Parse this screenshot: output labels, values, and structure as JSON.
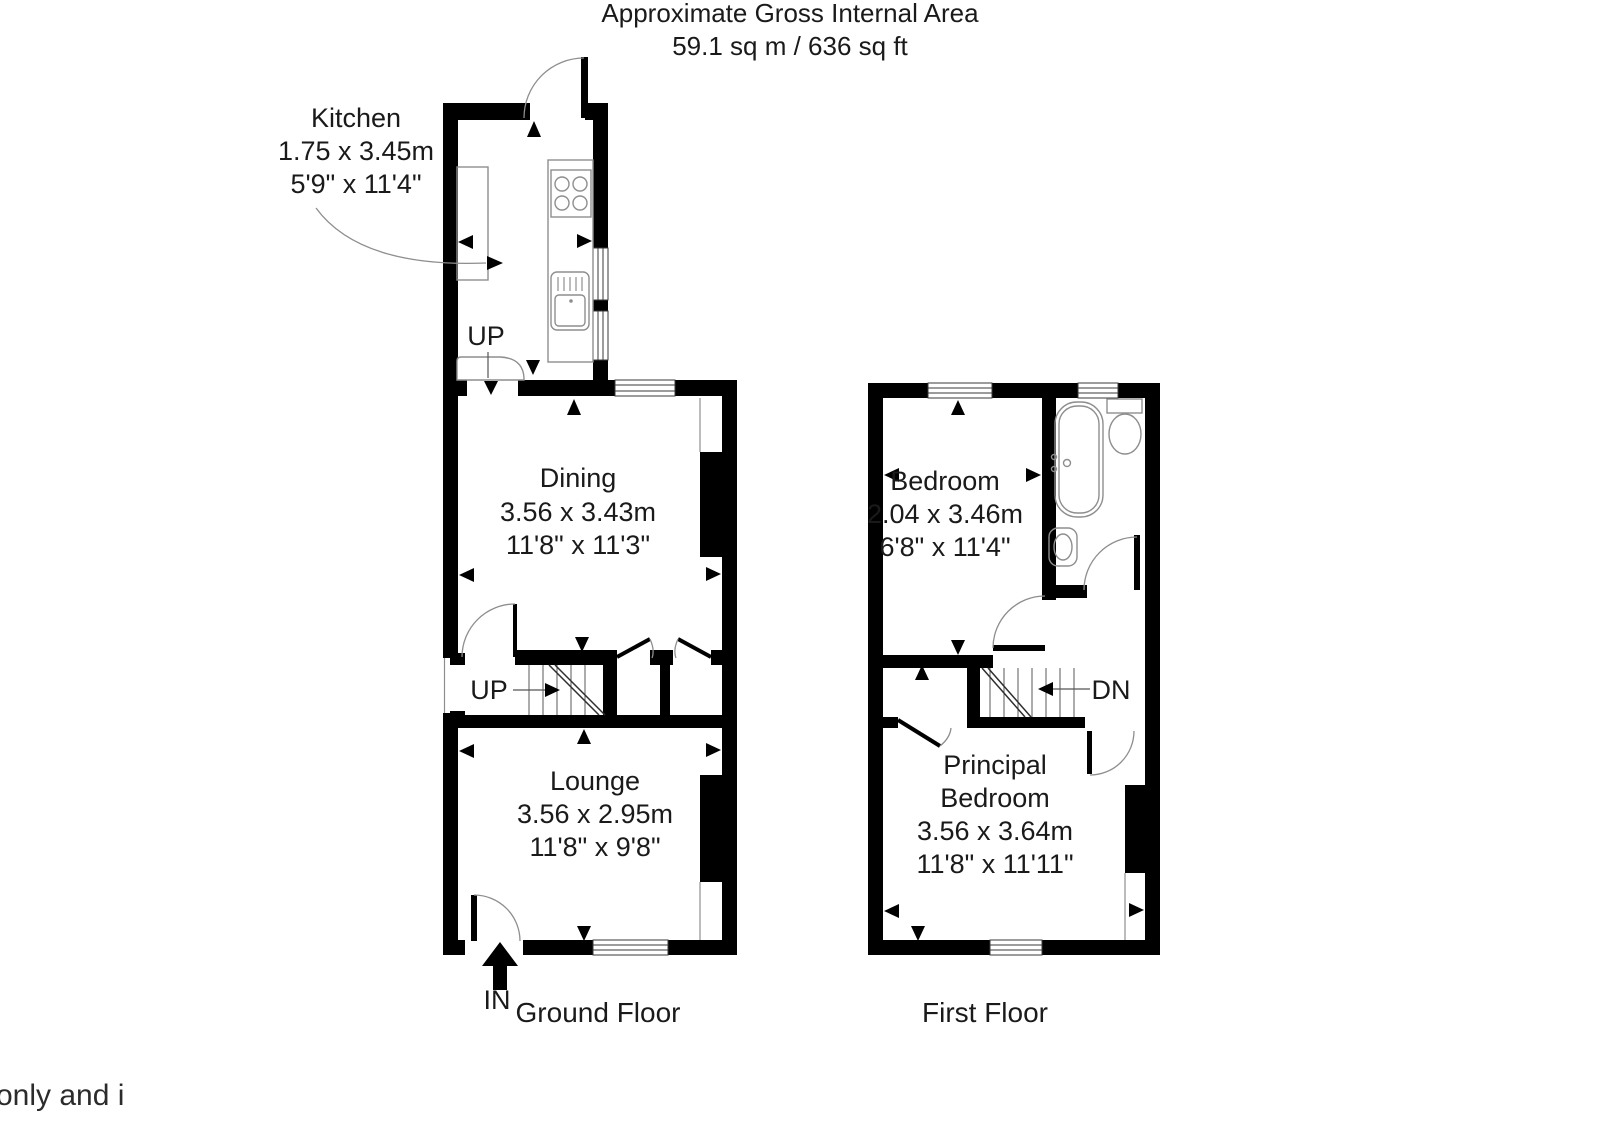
{
  "header": {
    "title_line1": "Approximate Gross Internal Area",
    "title_line2": "59.1 sq m / 636 sq ft"
  },
  "ground_floor": {
    "caption": "Ground Floor",
    "entrance_label": "IN",
    "kitchen": {
      "name": "Kitchen",
      "metric": "1.75 x 3.45m",
      "imperial": "5'9\" x 11'4\""
    },
    "dining": {
      "name": "Dining",
      "metric": "3.56 x 3.43m",
      "imperial": "11'8\" x 11'3\""
    },
    "lounge": {
      "name": "Lounge",
      "metric": "3.56 x 2.95m",
      "imperial": "11'8\" x 9'8\""
    },
    "kitchen_stairs_label": "UP",
    "main_stairs_label": "UP"
  },
  "first_floor": {
    "caption": "First Floor",
    "bedroom": {
      "name": "Bedroom",
      "metric": "2.04 x 3.46m",
      "imperial": "6'8\" x 11'4\""
    },
    "principal_bedroom": {
      "name_line1": "Principal",
      "name_line2": "Bedroom",
      "metric": "3.56 x 3.64m",
      "imperial": "11'8\" x 11'11\""
    },
    "stairs_label": "DN"
  },
  "footer": {
    "partial_text": "only and i"
  },
  "colors": {
    "wall": "#000000",
    "fixture_line": "#8e8e8e",
    "text": "#1a1a1a",
    "background": "#ffffff"
  }
}
